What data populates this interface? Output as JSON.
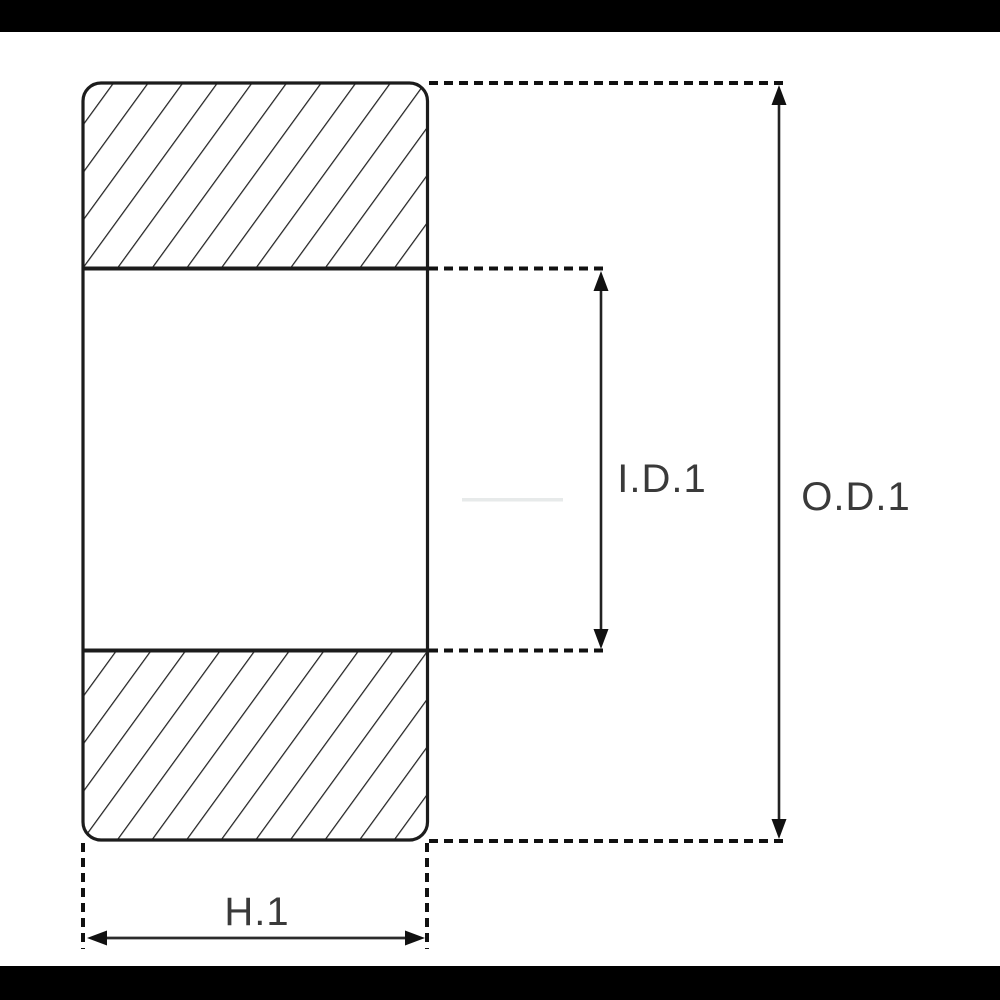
{
  "page": {
    "background": "#ffffff",
    "letterbox_color": "#000000"
  },
  "diagram": {
    "type": "bearing-cross-section-technical-drawing",
    "labels": {
      "inner_diameter": "I.D.1",
      "outer_diameter": "O.D.1",
      "width": "H.1"
    },
    "colors": {
      "outline": "#1c1c1c",
      "hatch": "#222222",
      "text": "#3a3a3a",
      "fill": "#ffffff",
      "watermark_artifact": "#e7eaea"
    }
  }
}
